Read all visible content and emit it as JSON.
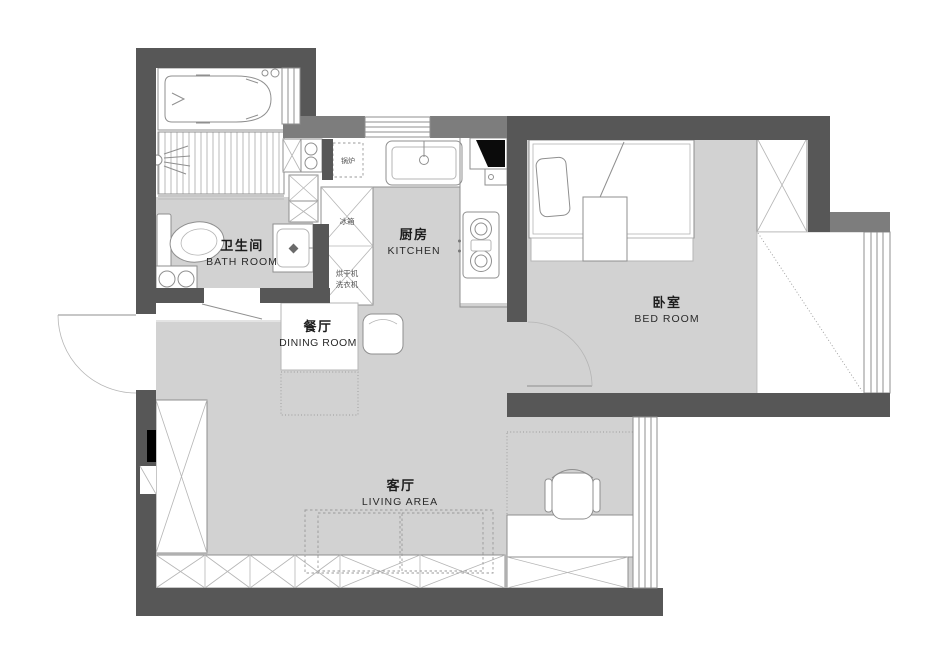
{
  "plan_title": "apartment-floor-plan",
  "colors": {
    "wall_dark": "#575757",
    "wall_medium": "#7d7d7d",
    "floor_gray": "#d2d2d2",
    "background": "#ffffff",
    "line_gray": "#8f8f8f"
  },
  "rooms": [
    {
      "id": "bathroom",
      "label_zh": "卫生间",
      "label_en": "BATH  ROOM"
    },
    {
      "id": "kitchen",
      "label_zh": "厨房",
      "label_en": "KITCHEN"
    },
    {
      "id": "bedroom",
      "label_zh": "卧室",
      "label_en": "BED  ROOM"
    },
    {
      "id": "dining",
      "label_zh": "餐厅",
      "label_en": "DINING ROOM"
    },
    {
      "id": "living",
      "label_zh": "客厅",
      "label_en": "LIVING  AREA"
    }
  ],
  "fixtures": {
    "boiler": "锅炉",
    "fridge": "冰箱",
    "dryer": "烘干机",
    "washer": "洗衣机"
  }
}
